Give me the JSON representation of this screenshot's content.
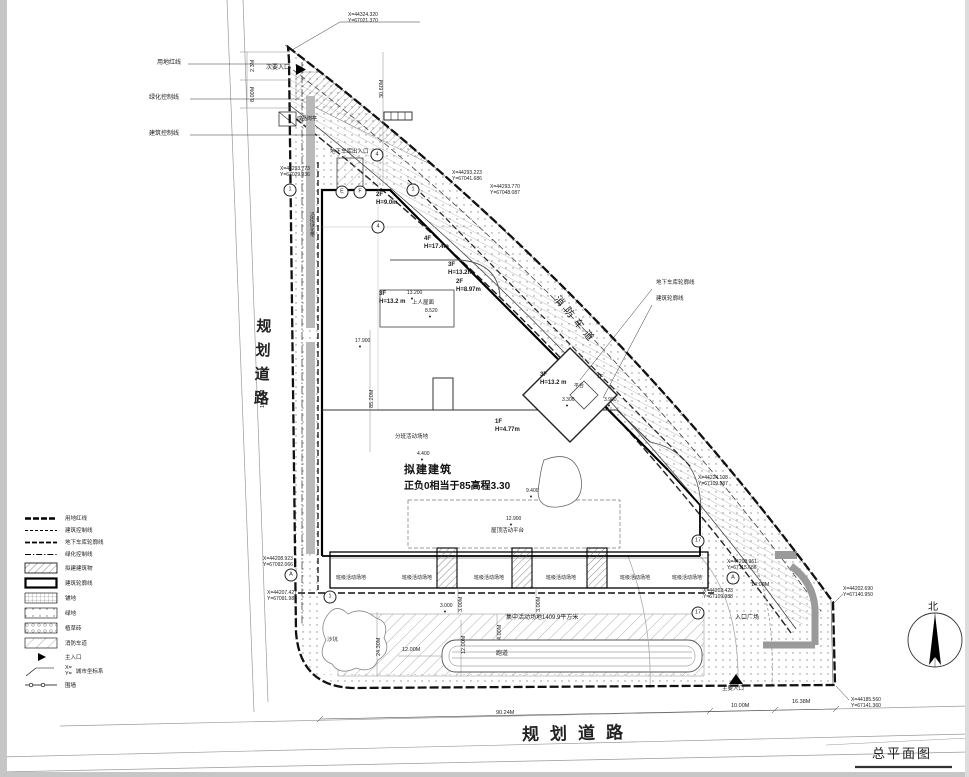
{
  "sheet": {
    "title": "总平面图",
    "north_label": "北"
  },
  "roads": {
    "left": "规划道路",
    "bottom": "规划道路"
  },
  "note": {
    "line1": "拟建建筑",
    "line2": "正负0相当于85高程3.30"
  },
  "legend": {
    "coord_symbol": {
      "x": "X=",
      "y": "Y="
    },
    "items": [
      {
        "label": "用地红线"
      },
      {
        "label": "建筑控制线"
      },
      {
        "label": "地下车库轮廓线"
      },
      {
        "label": "绿化控制线"
      },
      {
        "label": "拟建建筑物"
      },
      {
        "label": "建筑轮廓线"
      },
      {
        "label": "铺地"
      },
      {
        "label": "绿地"
      },
      {
        "label": "植草砖"
      },
      {
        "label": "消防车道"
      },
      {
        "label": "主入口"
      },
      {
        "label": "城市坐标系"
      },
      {
        "label": "围墙"
      }
    ]
  },
  "coords": [
    {
      "x": 348,
      "y": 12,
      "l1": "X=44324.320",
      "l2": "Y=67021.370"
    },
    {
      "x": 280,
      "y": 166,
      "l1": "X=44293.773",
      "l2": "Y=67029.936"
    },
    {
      "x": 452,
      "y": 170,
      "l1": "X=44293.223",
      "l2": "Y=67041.686"
    },
    {
      "x": 490,
      "y": 184,
      "l1": "X=44293.770",
      "l2": "Y=67048.087"
    },
    {
      "x": 698,
      "y": 475,
      "l1": "X=44224.108",
      "l2": "Y=67109.987"
    },
    {
      "x": 727,
      "y": 559,
      "l1": "X=44208.961",
      "l2": "Y=67115.686"
    },
    {
      "x": 703,
      "y": 588,
      "l1": "X=44202.423",
      "l2": "Y=67109.988"
    },
    {
      "x": 843,
      "y": 586,
      "l1": "X=44202.690",
      "l2": "Y=67140.950"
    },
    {
      "x": 851,
      "y": 697,
      "l1": "X=44185.560",
      "l2": "Y=67141.360"
    },
    {
      "x": 263,
      "y": 556,
      "l1": "X=44208.923",
      "l2": "Y=67092.066"
    },
    {
      "x": 267,
      "y": 590,
      "l1": "X=44207.427",
      "l2": "Y=67091.986"
    }
  ],
  "dims": [
    {
      "t": "2.3M",
      "x": 250,
      "y": 72,
      "r": -90
    },
    {
      "t": "8.00M",
      "x": 250,
      "y": 102,
      "r": -90
    },
    {
      "t": "30.60M",
      "x": 379,
      "y": 98,
      "r": -90
    },
    {
      "t": "13.12M",
      "x": 260,
      "y": 408,
      "r": -90
    },
    {
      "t": "85.20M",
      "x": 369,
      "y": 408,
      "r": -90
    },
    {
      "t": "24.30M",
      "x": 376,
      "y": 656,
      "r": -90
    },
    {
      "t": "12.00M",
      "x": 461,
      "y": 654,
      "r": -90
    },
    {
      "t": "12.00M",
      "x": 402,
      "y": 647
    },
    {
      "t": "4.00M",
      "x": 497,
      "y": 640,
      "r": -90
    },
    {
      "t": "3.00M",
      "x": 458,
      "y": 612,
      "r": -90
    },
    {
      "t": "3.00M",
      "x": 536,
      "y": 612,
      "r": -90
    },
    {
      "t": "90.24M",
      "x": 496,
      "y": 710
    },
    {
      "t": "10.00M",
      "x": 731,
      "y": 703
    },
    {
      "t": "16.38M",
      "x": 792,
      "y": 699
    },
    {
      "t": "14.06M",
      "x": 751,
      "y": 582
    }
  ],
  "levels": [
    {
      "t": "3.300",
      "x": 562,
      "y": 398
    },
    {
      "t": "3.900",
      "x": 604,
      "y": 398
    },
    {
      "t": "3.000",
      "x": 440,
      "y": 604
    },
    {
      "t": "4.400",
      "x": 417,
      "y": 452
    },
    {
      "t": "12.900",
      "x": 506,
      "y": 517
    },
    {
      "t": "17.900",
      "x": 355,
      "y": 339
    },
    {
      "t": "13.200",
      "x": 407,
      "y": 291
    },
    {
      "t": "8.520",
      "x": 425,
      "y": 309
    },
    {
      "t": "9.400",
      "x": 526,
      "y": 489
    }
  ],
  "floors": [
    {
      "f": "2F",
      "h": "H=9.0m",
      "x": 376,
      "y": 192
    },
    {
      "f": "4F",
      "h": "H=17.4m",
      "x": 424,
      "y": 236
    },
    {
      "f": "3F",
      "h": "H=13.2m",
      "x": 448,
      "y": 262
    },
    {
      "f": "2F",
      "h": "H=8.97m",
      "x": 456,
      "y": 279
    },
    {
      "f": "3F",
      "h": "H=13.2 m",
      "x": 379,
      "y": 291
    },
    {
      "f": "3F",
      "h": "H=13.2 m",
      "x": 540,
      "y": 372
    },
    {
      "f": "1F",
      "h": "H=4.77m",
      "x": 495,
      "y": 419
    }
  ],
  "labels": [
    {
      "t": "用地红线",
      "x": 157,
      "y": 60,
      "fs": 6
    },
    {
      "t": "绿化控制线",
      "x": 149,
      "y": 95,
      "fs": 6
    },
    {
      "t": "建筑控制线",
      "x": 149,
      "y": 131,
      "fs": 6
    },
    {
      "t": "次要入口",
      "x": 266,
      "y": 65,
      "fs": 6
    },
    {
      "t": "成品岗亭",
      "x": 297,
      "y": 117,
      "fs": 5
    },
    {
      "t": "地下车库出入口",
      "x": 330,
      "y": 149,
      "fs": 5.5
    },
    {
      "t": "地下车库轮廓线",
      "x": 656,
      "y": 280,
      "fs": 5.5
    },
    {
      "t": "建筑轮廓线",
      "x": 656,
      "y": 296,
      "fs": 5.5
    },
    {
      "t": "消防车道",
      "x": 560,
      "y": 294,
      "fs": 10,
      "r": 50,
      "ls": 5
    },
    {
      "t": "上人屋面",
      "x": 412,
      "y": 300,
      "fs": 5.5
    },
    {
      "t": "平台",
      "x": 574,
      "y": 384,
      "fs": 5
    },
    {
      "t": "1F",
      "x": 597,
      "y": 374,
      "fs": 5.5
    },
    {
      "t": "分班活动场地",
      "x": 395,
      "y": 434,
      "fs": 5.5
    },
    {
      "t": "屋顶活动平台",
      "x": 491,
      "y": 528,
      "fs": 5.5
    },
    {
      "t": "沿街绿化带",
      "x": 308,
      "y": 212,
      "fs": 5,
      "v": 1
    },
    {
      "t": "沙坑",
      "x": 327,
      "y": 637,
      "fs": 5.5
    },
    {
      "t": "跑道",
      "x": 496,
      "y": 651,
      "fs": 6
    },
    {
      "t": "集中活动场地1409.9平方米",
      "x": 506,
      "y": 615,
      "fs": 6
    },
    {
      "t": "入口广场",
      "x": 735,
      "y": 615,
      "fs": 6
    },
    {
      "t": "主要入口",
      "x": 722,
      "y": 686,
      "fs": 5.5
    },
    {
      "t": "班级活动场地",
      "x": 336,
      "y": 576,
      "fs": 5
    },
    {
      "t": "班级活动场地",
      "x": 402,
      "y": 576,
      "fs": 5
    },
    {
      "t": "班级活动场地",
      "x": 474,
      "y": 576,
      "fs": 5
    },
    {
      "t": "班级活动场地",
      "x": 546,
      "y": 576,
      "fs": 5
    },
    {
      "t": "班级活动场地",
      "x": 620,
      "y": 576,
      "fs": 5
    },
    {
      "t": "班级活动场地",
      "x": 672,
      "y": 576,
      "fs": 5
    }
  ],
  "bubbles": [
    {
      "t": "4",
      "x": 377,
      "y": 155
    },
    {
      "t": "1",
      "x": 290,
      "y": 190
    },
    {
      "t": "E",
      "x": 342,
      "y": 192
    },
    {
      "t": "F",
      "x": 360,
      "y": 192
    },
    {
      "t": "1",
      "x": 413,
      "y": 190
    },
    {
      "t": "4",
      "x": 378,
      "y": 227
    },
    {
      "t": "A",
      "x": 291,
      "y": 575
    },
    {
      "t": "1",
      "x": 330,
      "y": 597
    },
    {
      "t": "A",
      "x": 733,
      "y": 578
    },
    {
      "t": "17",
      "x": 698,
      "y": 541
    },
    {
      "t": "17",
      "x": 698,
      "y": 613
    }
  ]
}
